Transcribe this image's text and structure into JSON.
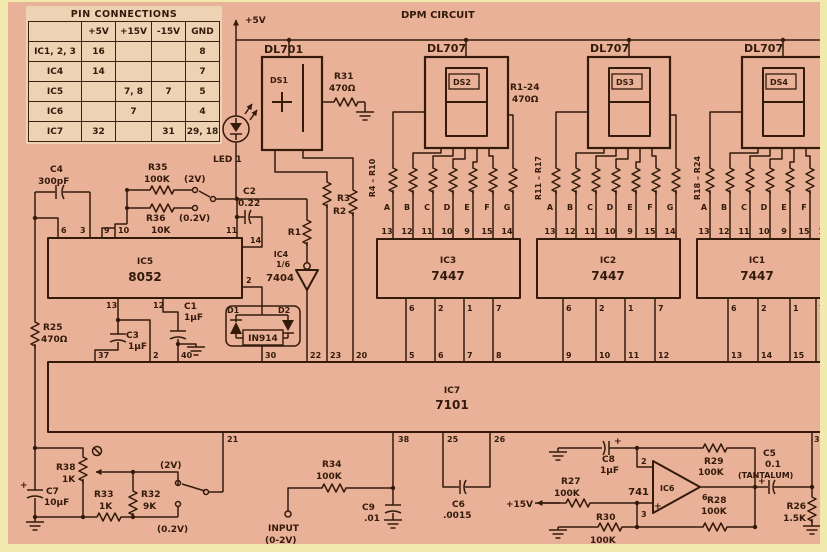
{
  "colors": {
    "frame": "#f2e9ad",
    "board": "#e9b197",
    "ink": "#331a0b",
    "table_bg": "#edd2b3"
  },
  "header": {
    "rail_label": "+5V",
    "title": "DPM CIRCUIT"
  },
  "pin_table": {
    "title": "PIN CONNECTIONS",
    "col_headers": [
      "+5V",
      "+15V",
      "-15V",
      "GND"
    ],
    "rows": [
      {
        "name": "IC1, 2, 3",
        "p5": "16",
        "p15": "",
        "m15": "",
        "gnd": "8"
      },
      {
        "name": "IC4",
        "p5": "14",
        "p15": "",
        "m15": "",
        "gnd": "7"
      },
      {
        "name": "IC5",
        "p5": "",
        "p15": "7, 8",
        "m15": "7",
        "gnd": "5"
      },
      {
        "name": "IC6",
        "p5": "",
        "p15": "7",
        "m15": "",
        "gnd": "4"
      },
      {
        "name": "IC7",
        "p5": "32",
        "p15": "",
        "m15": "31",
        "gnd": "29, 18"
      }
    ]
  },
  "displays": {
    "ds1_part": "DL701",
    "ds1_name": "DS1",
    "dl707": "DL707",
    "ds2": "DS2",
    "ds3": "DS3",
    "ds4": "DS4",
    "led": "LED 1",
    "bank_note_ref": "R1-24",
    "bank_note_val": "470Ω",
    "bank_ranges": [
      "R4 – R10",
      "R11 – R17",
      "R18 – R24"
    ],
    "seg_letters": [
      "A",
      "B",
      "C",
      "D",
      "E",
      "F",
      "G"
    ],
    "seg_pins": [
      "13",
      "12",
      "11",
      "10",
      "9",
      "15",
      "14"
    ]
  },
  "decoders": {
    "ic3": "IC3",
    "ic2": "IC2",
    "ic1": "IC1",
    "part": "7447",
    "out_pins": [
      "6",
      "2",
      "1",
      "7"
    ]
  },
  "ic5": {
    "ref": "IC5",
    "part": "8052",
    "top_pins": [
      "6",
      "3",
      "9",
      "10",
      "11"
    ],
    "pin14": "14",
    "pin2": "2",
    "bottom_pins": [
      "13",
      "12"
    ]
  },
  "ic4": {
    "ref": "IC4",
    "fraction": "1/6",
    "part": "7404"
  },
  "ic7": {
    "ref": "IC7",
    "part": "7101",
    "top_pins": [
      "37",
      "2",
      "40",
      "30",
      "22",
      "23",
      "20",
      "5",
      "6",
      "7",
      "8",
      "9",
      "10",
      "11",
      "12",
      "13",
      "14",
      "15",
      "16"
    ],
    "bottom_pins": [
      "21",
      "38",
      "25",
      "26",
      "36"
    ]
  },
  "opamp": {
    "part": "741",
    "ref": "IC6",
    "pin2": "2",
    "pin3": "3",
    "pin6": "6",
    "plus": "+"
  },
  "components": {
    "r31": {
      "ref": "R31",
      "val": "470Ω"
    },
    "r25": {
      "ref": "R25",
      "val": "470Ω"
    },
    "r35": {
      "ref": "R35",
      "val": "100K"
    },
    "r36": {
      "ref": "R36",
      "val": "10K"
    },
    "r1": "R1",
    "r2": "R2",
    "r3": "R3",
    "c4": {
      "ref": "C4",
      "val": "300pF"
    },
    "c2": {
      "ref": "C2",
      "val": "0.22"
    },
    "c1": {
      "ref": "C1",
      "val": "1µF"
    },
    "c3": {
      "ref": "C3",
      "val": "1µF"
    },
    "d1": "D1",
    "d2": "D2",
    "diode_part": "IN914",
    "c7": {
      "ref": "C7",
      "val": "10µF"
    },
    "r38": {
      "ref": "R38",
      "val": "1K"
    },
    "r33": {
      "ref": "R33",
      "val": "1K"
    },
    "r32": {
      "ref": "R32",
      "val": "9K"
    },
    "r34": {
      "ref": "R34",
      "val": "100K"
    },
    "c9": {
      "ref": "C9",
      "val": ".01"
    },
    "c6": {
      "ref": "C6",
      "val": ".0015"
    },
    "c8": {
      "ref": "C8",
      "val": "1µF"
    },
    "r27": {
      "ref": "R27",
      "val": "100K"
    },
    "r30": {
      "ref": "R30",
      "val": "100K"
    },
    "r29": {
      "ref": "R29",
      "val": "100K"
    },
    "r28": {
      "ref": "R28",
      "val": "100K"
    },
    "c5": {
      "ref": "C5",
      "val": "0.1",
      "note": "(TANTALUM)"
    },
    "r26": {
      "ref": "R26",
      "val": "1.5K"
    },
    "polarity": "+"
  },
  "annotations": {
    "range_high_1": "(2V)",
    "range_low_1": "(0.2V)",
    "range_high_2": "(2V)",
    "range_low_2": "(0.2V)",
    "input_label": "INPUT",
    "input_range": "(0-2V)",
    "p15v": "+15V"
  }
}
